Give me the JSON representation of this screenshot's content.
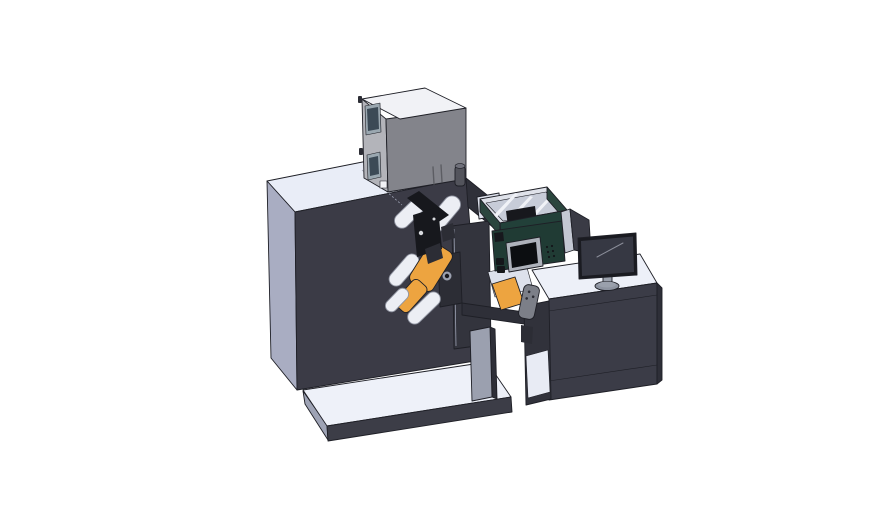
{
  "scene": {
    "type": "3d-cad-render",
    "subject": "roll-fed label printing machine with inkjet module, control pendant and operator desk with monitor",
    "background": "#ffffff"
  },
  "colors": {
    "bg": "#ffffff",
    "outline": "#1e1f26",
    "seam": "#9ba0b2",
    "machine_top": "#e9edf7",
    "machine_left": "#a9adc2",
    "machine_front": "#3b3b46",
    "machine_right": "#2f3039",
    "base_top": "#eef1f9",
    "base_front": "#3c3d47",
    "base_side": "#9ea3b5",
    "box_top": "#f1f2f6",
    "box_left": "#b3b4ba",
    "box_front": "#83848b",
    "window_frame": "#9aa7b0",
    "window_glass": "#3c4a56",
    "vent": "#5c5d63",
    "beacon_body": "#53545c",
    "beacon_top": "#6f707a",
    "roller": "#eceef4",
    "roller_stroke": "#8f93a0",
    "orange": "#eda440",
    "orange_dark": "#c9811f",
    "mech_dark": "#17181d",
    "mech_mid": "#2c2d35",
    "mech_dot": "#d8dade",
    "tower_plate": "#33343d",
    "leg_gray": "#9ba0af",
    "tray_wall": "#2b463e",
    "tray_wall_front": "#224039",
    "tray_rim": "#dfe2ea",
    "tray_floor": "#c7ccd8",
    "rail": "#f0f2f7",
    "magenta": "#c94fc3",
    "hmi_plate": "#203b34",
    "hmi_frame": "#aeb2bb",
    "hmi_screen": "#0c0e11",
    "hmi_button": "#14161a",
    "arm_dark": "#2e2f38",
    "arm_white": "#dde1ec",
    "pendant": "#7c7f88",
    "desk_top": "#edf0f8",
    "desk_front": "#3b3c47",
    "desk_right": "#2e2f38",
    "desk_side_dark": "#31323b",
    "shelf_white": "#e8ebf4",
    "panel_light": "#c3c7d2",
    "panel_dark": "#3a3b45",
    "monitor_bezel": "#1a1b21",
    "monitor_screen": "#363843",
    "monitor_highlight": "#8b8e9a",
    "stand": "#9aa0ac",
    "stand_base": "#8d93a0"
  },
  "components": [
    "main-cabinet",
    "electronics-box",
    "signal-beacon",
    "base-platform",
    "unwind-tower-plate",
    "web-roller",
    "label-roll",
    "printhead-mechanism",
    "inkjet-tray",
    "ink-cartridge",
    "hmi-control-panel",
    "transfer-arm",
    "handheld-pendant",
    "operator-desk",
    "desk-shelf",
    "side-panel-screen",
    "desktop-monitor",
    "monitor-stand"
  ]
}
